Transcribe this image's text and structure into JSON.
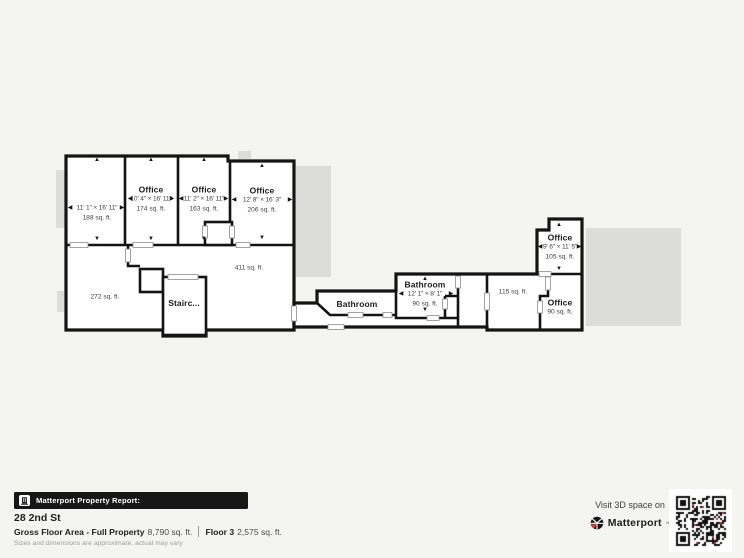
{
  "floor_plan": {
    "rooms": [
      {
        "dims": "11' 1\" × 16' 11\"",
        "area": "188 sq. ft."
      },
      {
        "name": "Office",
        "dims": "10' 4\" × 16' 11\"",
        "area": "174 sq. ft."
      },
      {
        "name": "Office",
        "dims": "11' 2\" × 16' 11\"",
        "area": "163 sq. ft."
      },
      {
        "name": "Office",
        "dims": "12' 8\" × 16' 3\"",
        "area": "206 sq. ft."
      },
      {
        "area": "272 sq. ft."
      },
      {
        "name": "Stairc..."
      },
      {
        "area": "411 sq. ft."
      },
      {
        "name": "Bathroom"
      },
      {
        "name": "Bathroom",
        "dims": "12' 1\" × 8' 1\"",
        "area": "90 sq. ft."
      },
      {
        "area": "115 sq. ft."
      },
      {
        "name": "Office",
        "dims": "9' 6\" × 11' 5\"",
        "area": "105 sq. ft."
      },
      {
        "name": "Office",
        "area": "90 sq. ft."
      }
    ]
  },
  "icons": {
    "arrow_up": "▲",
    "arrow_down": "▼",
    "arrow_left": "◀",
    "arrow_right": "▶"
  },
  "report": {
    "bar_label": "Matterport Property Report:",
    "address": "28 2nd St",
    "gross_label": "Gross Floor Area - Full Property",
    "gross_value": "8,790 sq. ft.",
    "floor_label": "Floor 3",
    "floor_value": "2,575 sq. ft.",
    "disclaimer": "Sizes and dimensions are approximate, actual may vary"
  },
  "promo": {
    "visit_text": "Visit 3D space on",
    "brand": "Matterport",
    "trademark": "™"
  },
  "colors": {
    "wall": "#141414",
    "shadow": "#dcdcd9",
    "background": "#f4f4f1",
    "brand_red": "#e0393e"
  }
}
